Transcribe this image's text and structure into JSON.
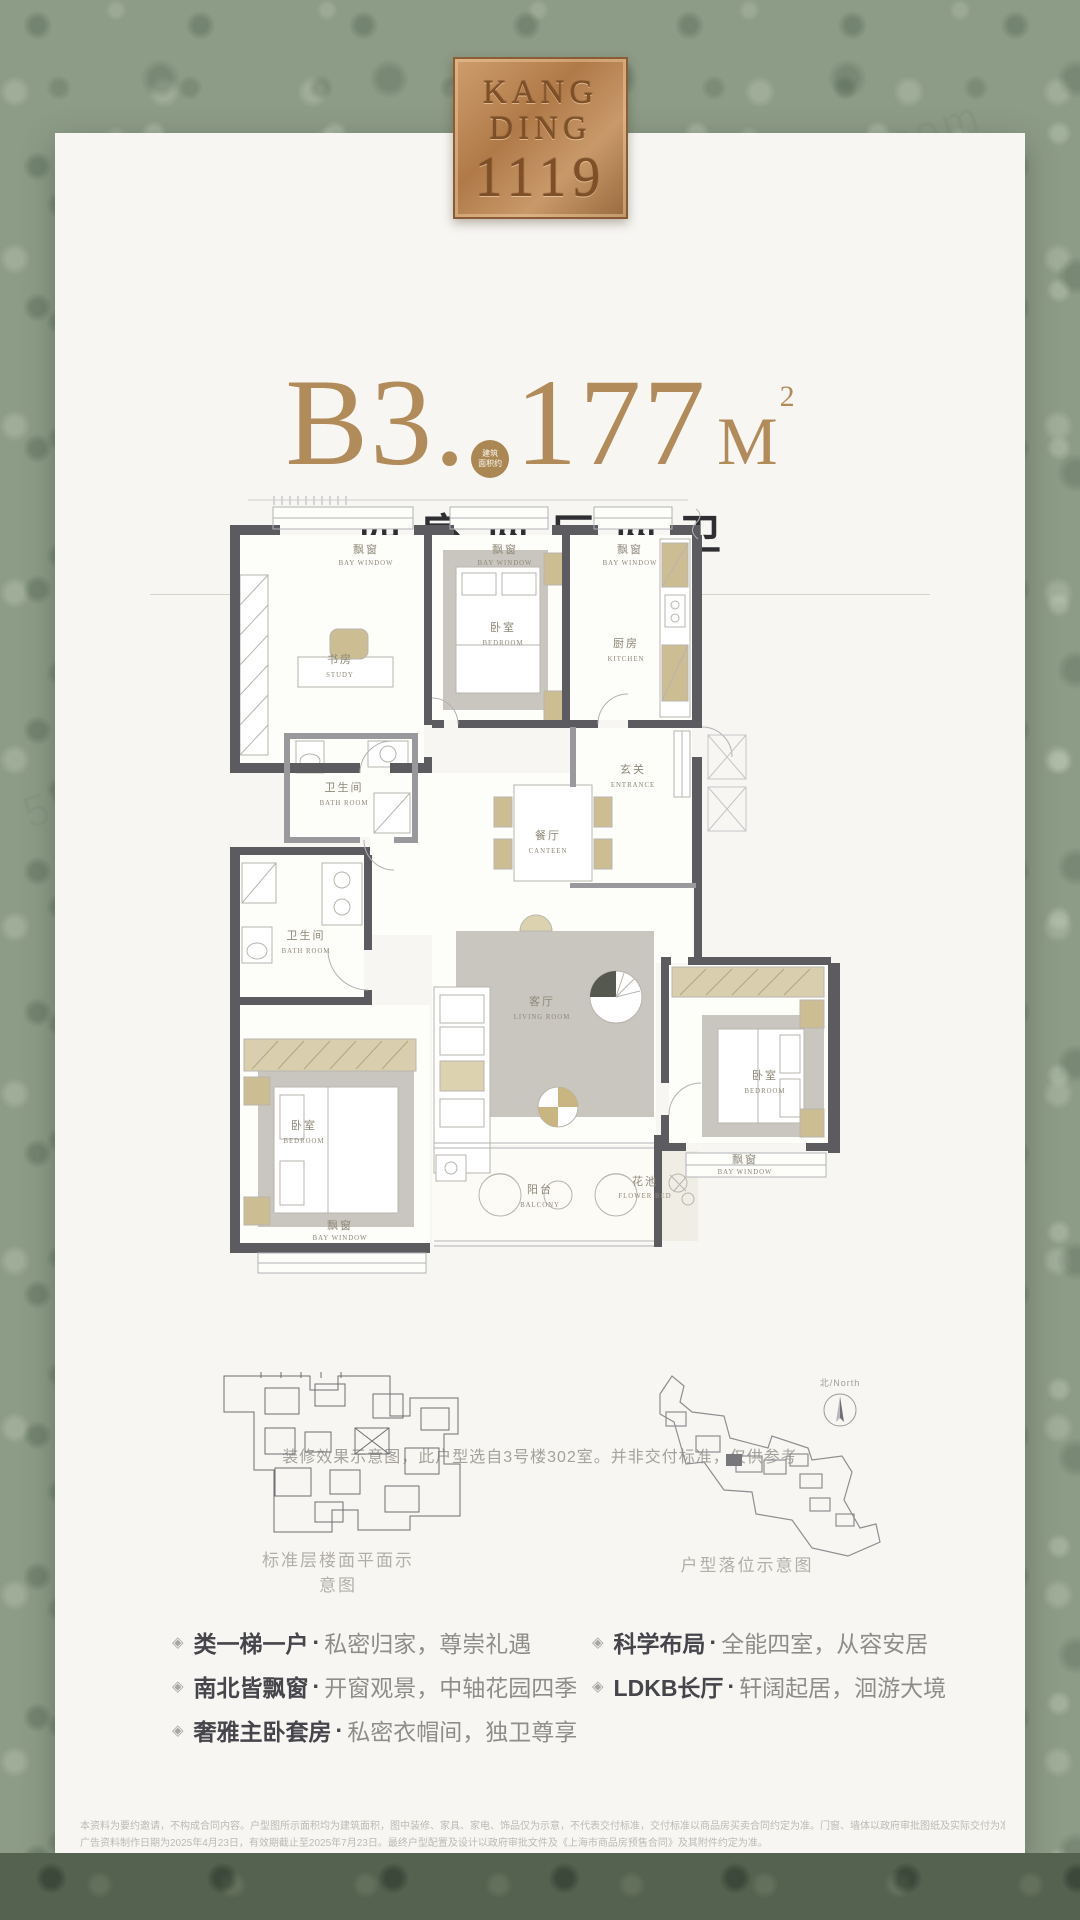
{
  "logo": {
    "line1": "KANG",
    "line2": "DING",
    "line3": "1119"
  },
  "title": {
    "prefix": "B3",
    "dot": ".",
    "badge_line1": "建筑",
    "badge_line2": "面积约",
    "number": "177",
    "unit": "M",
    "sup": "2"
  },
  "subtitle": "四室两厅两卫",
  "floorplan": {
    "caption": "装修效果示意图，此户型选自3号楼302室。并非交付标准，仅供参考",
    "rooms": [
      {
        "id": "bay-window-north-1",
        "zh": "飘窗",
        "en": "BAY WINDOW"
      },
      {
        "id": "bay-window-north-2",
        "zh": "飘窗",
        "en": "BAY WINDOW"
      },
      {
        "id": "bay-window-north-3",
        "zh": "飘窗",
        "en": "BAY WINDOW"
      },
      {
        "id": "study",
        "zh": "书房",
        "en": "STUDY"
      },
      {
        "id": "bedroom-north",
        "zh": "卧室",
        "en": "BEDROOM"
      },
      {
        "id": "kitchen",
        "zh": "厨房",
        "en": "KITCHEN"
      },
      {
        "id": "entrance",
        "zh": "玄关",
        "en": "ENTRANCE"
      },
      {
        "id": "bathroom-1",
        "zh": "卫生间",
        "en": "BATH ROOM"
      },
      {
        "id": "bathroom-2",
        "zh": "卫生间",
        "en": "BATH ROOM"
      },
      {
        "id": "dining",
        "zh": "餐厅",
        "en": "CANTEEN"
      },
      {
        "id": "living",
        "zh": "客厅",
        "en": "LIVING ROOM"
      },
      {
        "id": "bedroom-west",
        "zh": "卧室",
        "en": "BEDROOM"
      },
      {
        "id": "bay-window-west",
        "zh": "飘窗",
        "en": "BAY WINDOW"
      },
      {
        "id": "balcony",
        "zh": "阳台",
        "en": "BALCONY"
      },
      {
        "id": "flower-bed",
        "zh": "花池",
        "en": "FLOWER BED"
      },
      {
        "id": "bedroom-east",
        "zh": "卧室",
        "en": "BEDROOM"
      },
      {
        "id": "bay-window-east",
        "zh": "飘窗",
        "en": "BAY WINDOW"
      }
    ]
  },
  "diagrams": {
    "left_label": "标准层楼面平面示意图",
    "right_label": "户型落位示意图",
    "compass_label": "北/North"
  },
  "features": {
    "icon": "◈",
    "sep": "·",
    "left": [
      {
        "lead": "类一梯一户",
        "tail": "私密归家，尊崇礼遇"
      },
      {
        "lead": "南北皆飘窗",
        "tail": "开窗观景，中轴花园四季"
      },
      {
        "lead": "奢雅主卧套房",
        "tail": "私密衣帽间，独卫尊享"
      }
    ],
    "right": [
      {
        "lead": "科学布局",
        "tail": "全能四室，从容安居"
      },
      {
        "lead": "LDKB长厅",
        "tail": "轩阔起居，洄游大境"
      }
    ]
  },
  "disclaimer": {
    "line1": "本资料为要约邀请，不构成合同内容。户型图所示面积均为建筑面积，图中装修、家具、家电、饰品仅为示意，不代表交付标准，交付标准以商品房买卖合同约定为准。门窗、墙体以政府审批图纸及实际交付为准。",
    "line2": "广告资料制作日期为2025年4月23日，有效期截止至2025年7月23日。最终户型配置及设计以政府审批文件及《上海市商品房预售合同》及其附件约定为准。"
  },
  "watermark": "5i5j.com",
  "colors": {
    "gold": "#b18b59",
    "bronze": "#b07a48",
    "green_bg": "#8d9c87",
    "card_bg": "#f7f6f2"
  }
}
